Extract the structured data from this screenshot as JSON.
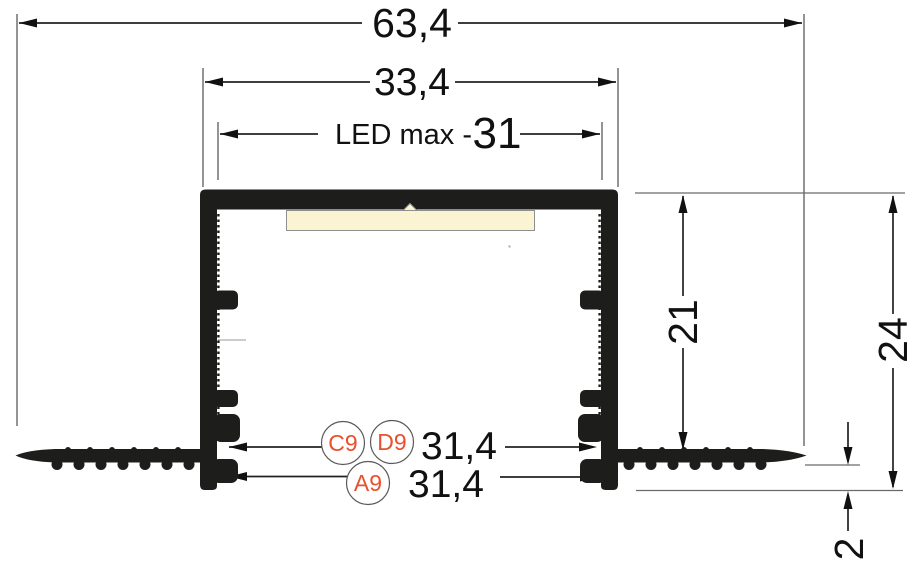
{
  "drawing": {
    "dims": {
      "overall_width": "63,4",
      "outer_body_width": "33,4",
      "led_max_label": "LED max  -",
      "led_max_value": "31",
      "inner_depth": "21",
      "total_depth": "24",
      "edge_thickness": "2",
      "notch_width_upper": "31,4",
      "notch_width_lower": "31,4"
    },
    "callouts": {
      "c": "C9",
      "d": "D9",
      "a": "A9"
    },
    "colors": {
      "profile_fill": "#1d1d1b",
      "dimension_line": "#222222",
      "reference_line": "#6a6a6a",
      "led_strip_fill": "#faf4d2",
      "led_strip_stroke": "#8f8f8f",
      "callout_text": "#e8502e",
      "callout_ring": "#5a5a5a",
      "background": "#ffffff"
    }
  }
}
